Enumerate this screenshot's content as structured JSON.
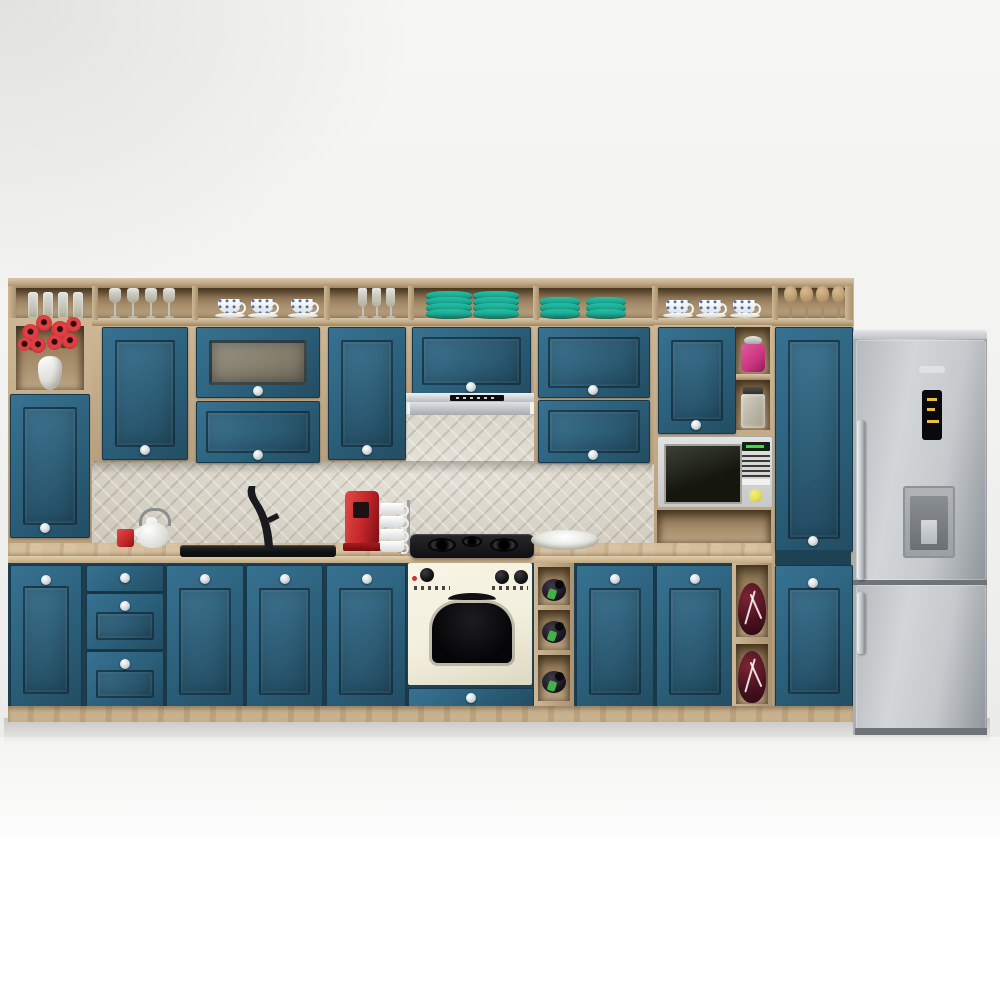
{
  "meta": {
    "type": "3d-render",
    "subject": "kitchen furniture set with appliances"
  },
  "palette": {
    "wall_a": "#f6f6f5",
    "wall_b": "#ececea",
    "teal": "#2b5f7a",
    "teal_hi": "#377291",
    "teal_lo": "#234d63",
    "teal_edge": "#16384a",
    "teal_gap": "#1d4254",
    "wood": "#c0a886",
    "wood_hi": "#d8c6a8",
    "wood_lo": "#9f855f",
    "splash": "#dcd8cc",
    "steel_a": "#ced2d5",
    "steel_b": "#9aa0a5",
    "cream": "#f3efdd",
    "appliance_black": "#17181b",
    "red": "#c3262a",
    "maroon": "#4a1120",
    "pink": "#ca3480",
    "plate": "#1bab95",
    "label_green": "#43b04a",
    "china_blue": "#4a6fae",
    "mw_green": "#3ddc46",
    "fr_yellow": "#e8c040",
    "btn_yellow": "#e3dd4e"
  },
  "labels": {
    "scene": "Teal and oak kitchen 3D render",
    "hutch": "Open oak top shelf with dishware",
    "left_unit": "Tall open-shelf end unit",
    "flowers": "Red flowers in white vase",
    "short_glasses": "Glass tumblers",
    "stem_glasses": "Stemmed wine glasses",
    "coffee_cups": "Porcelain coffee cups with saucers",
    "flutes": "Champagne flutes",
    "teal_plates": "Stacked teal plates",
    "teacups": "Patterned teacups",
    "wooden_spoons": "Wooden spoons",
    "wall_cabinet": "Teal wall cabinet",
    "glass_cabinet": "Frosted-glass wall cabinet",
    "range_hood": "Stainless slim range hood",
    "microwave": "Built-in microwave oven",
    "pink_jar": "Pink canister",
    "glass_jar": "Glass canister",
    "pantry": "Tall teal pantry column",
    "fridge": "Stainless fridge-freezer",
    "fridge_logo": "Fridge brand badge",
    "fridge_display": "Fridge temperature display",
    "water_dispenser": "Door water dispenser",
    "backsplash": "Mosaic tile backsplash",
    "countertop": "Oak worktop",
    "teapot": "White teapot",
    "red_mug": "Red mug",
    "sink": "Black flush sink",
    "faucet": "Black curved faucet",
    "coffee_machine": "Red espresso machine",
    "mug_tree": "Mug stand with white mugs",
    "cooktop": "Black gas hob",
    "serving_dish": "White serving dish",
    "oven": "Cream retro built-in oven",
    "oven_drawer": "Teal drawer under oven",
    "base_door": "Teal base cabinet door",
    "drawer": "Teal drawer front",
    "wine_rack": "Open wine rack",
    "wine_bottle": "Wine bottle",
    "decor_vase": "Dark red crackle vase",
    "plinth": "Oak plinth"
  }
}
